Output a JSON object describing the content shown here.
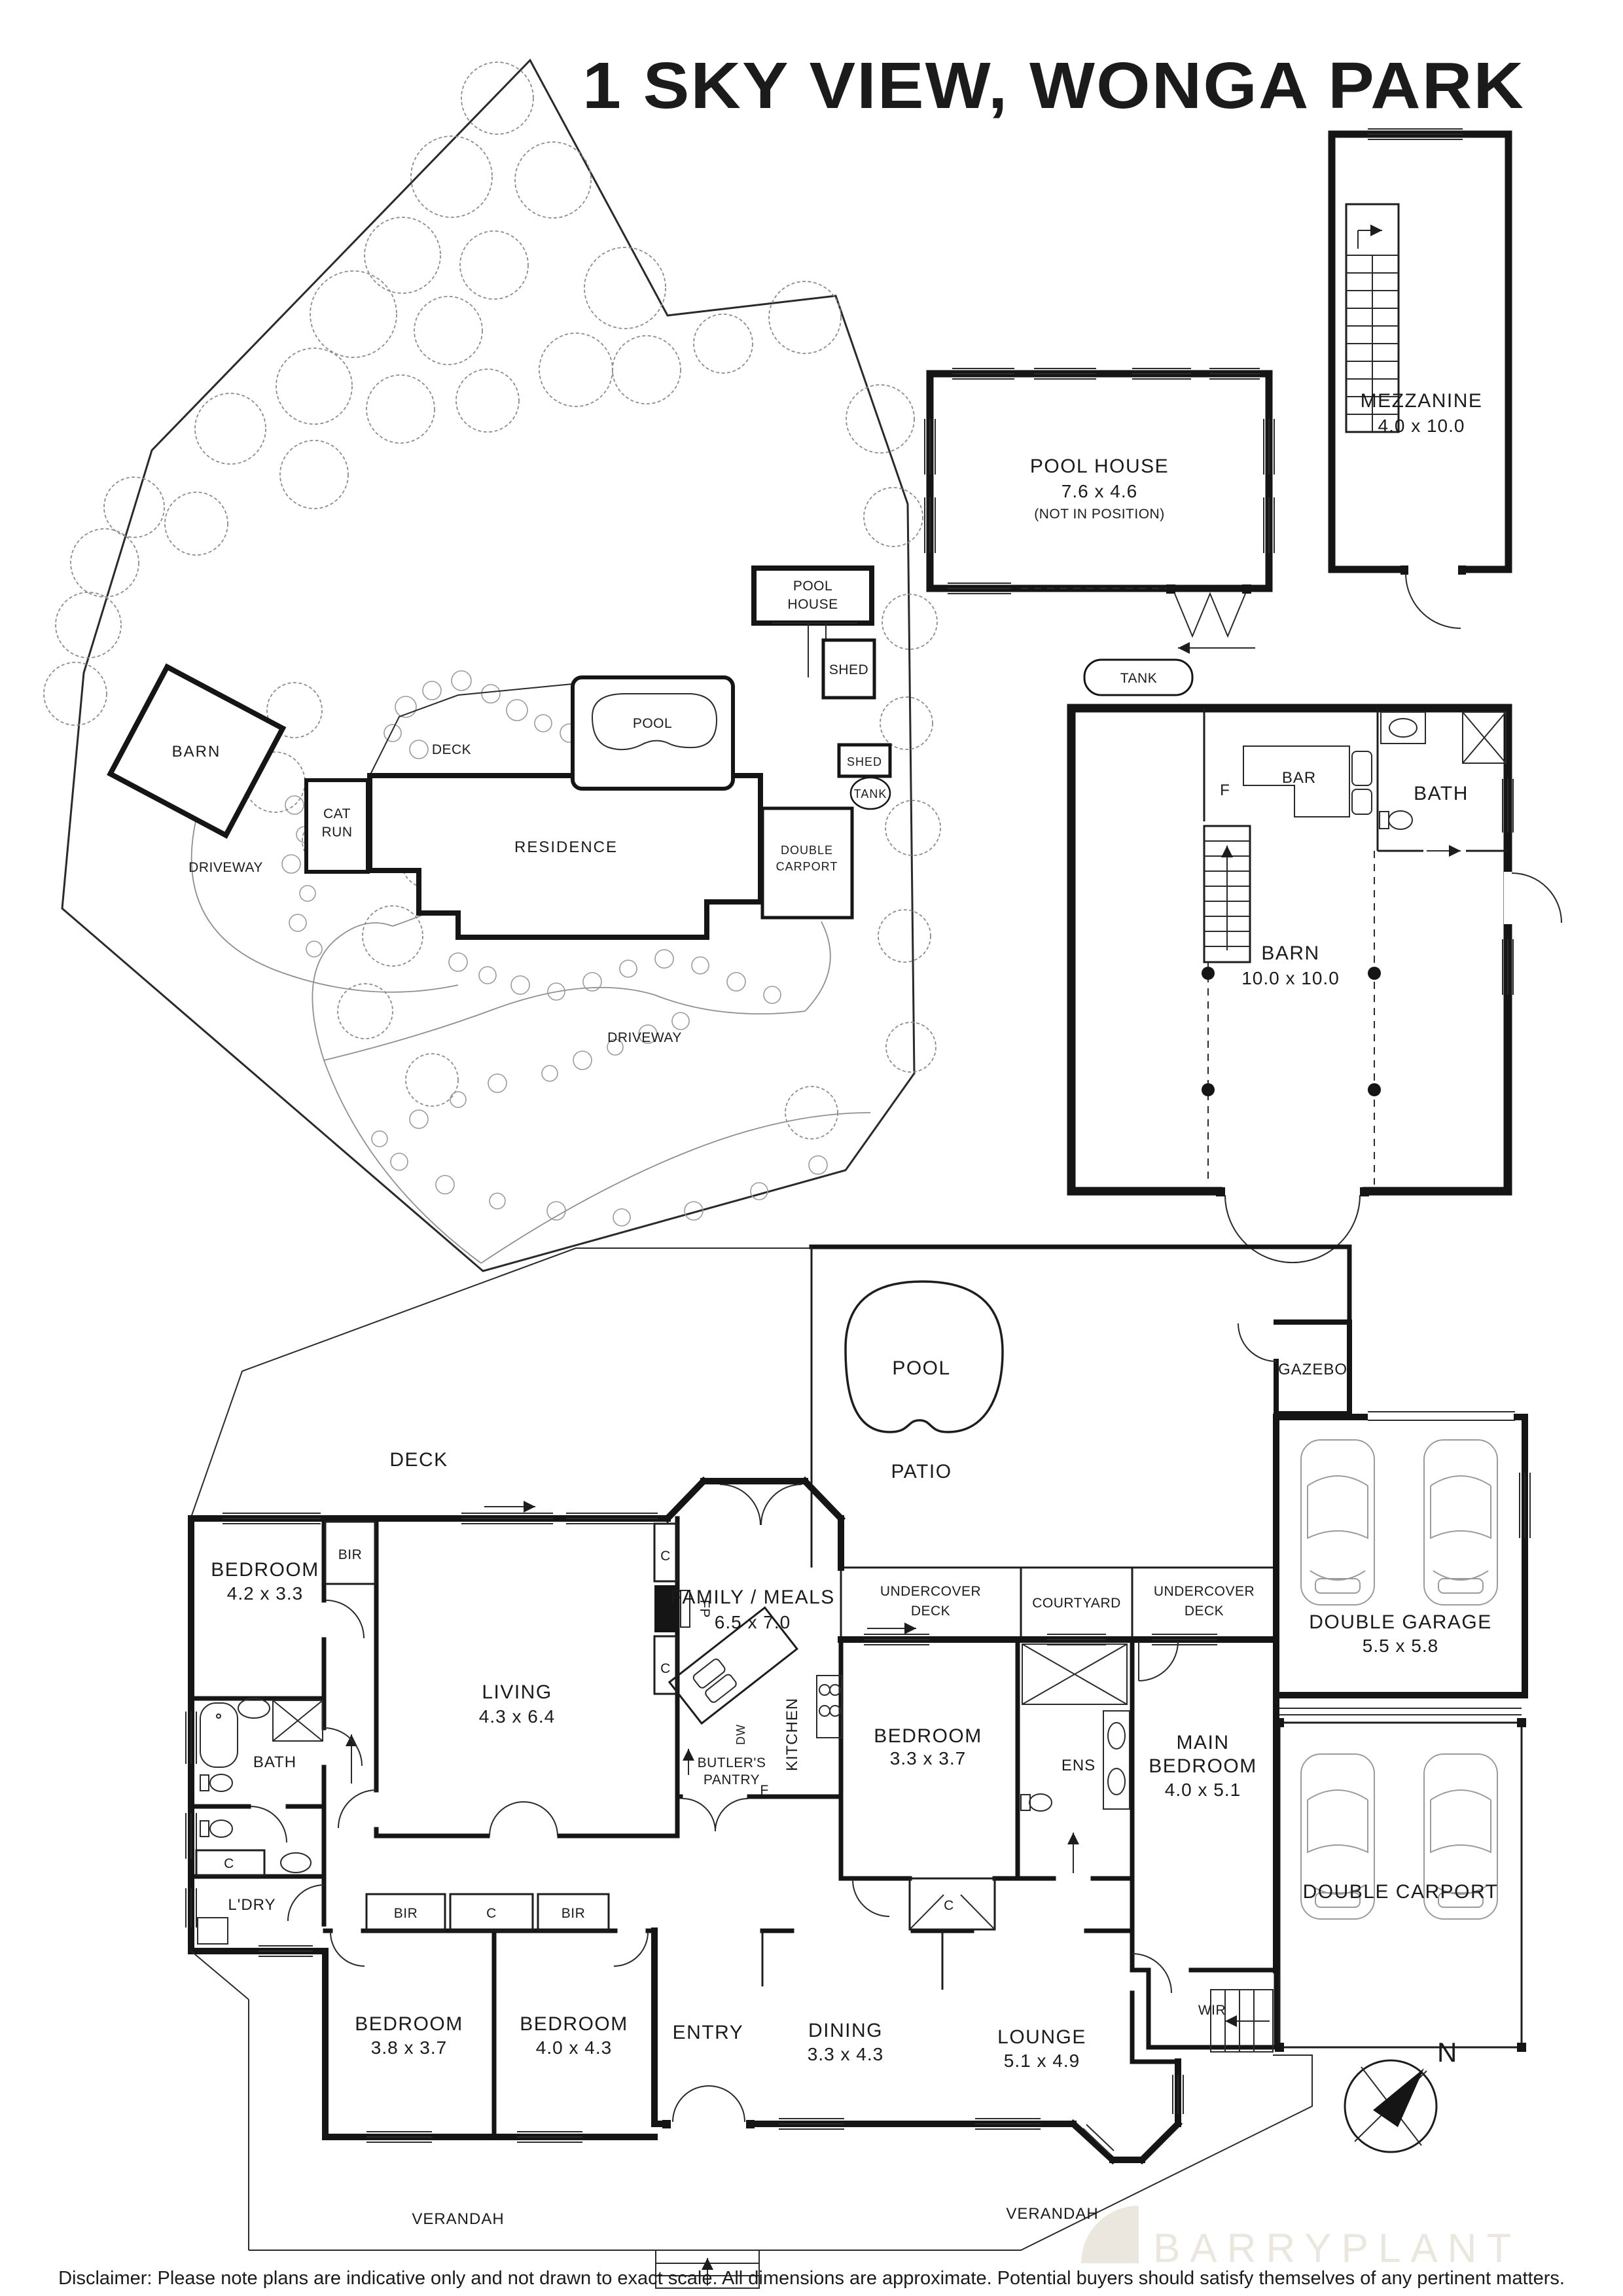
{
  "title": "1 SKY VIEW, WONGA PARK",
  "disclaimer": "Disclaimer: Please note plans are indicative only and not drawn to exact scale. All dimensions are approximate. Potential buyers should satisfy themselves of any pertinent matters.",
  "watermark": {
    "brand": "BARRYPLANT"
  },
  "compass": {
    "north": "N"
  },
  "site_plan": {
    "barn": "BARN",
    "driveway1": "DRIVEWAY",
    "driveway2": "DRIVEWAY",
    "cat_run_l1": "CAT",
    "cat_run_l2": "RUN",
    "deck": "DECK",
    "residence": "RESIDENCE",
    "pool": "POOL",
    "pool_house_l1": "POOL",
    "pool_house_l2": "HOUSE",
    "shed1": "SHED",
    "shed2": "SHED",
    "tank": "TANK",
    "carport_l1": "DOUBLE",
    "carport_l2": "CARPORT"
  },
  "pool_house_plan": {
    "name": "POOL HOUSE",
    "dims": "7.6 x 4.6",
    "note": "(NOT IN POSITION)"
  },
  "mezzanine_plan": {
    "name": "MEZZANINE",
    "dims": "4.0 x 10.0"
  },
  "barn_plan": {
    "tank": "TANK",
    "fridge": "F",
    "bar": "BAR",
    "bath": "BATH",
    "name": "BARN",
    "dims": "10.0 x 10.0"
  },
  "floor_plan": {
    "deck": "DECK",
    "pool": "POOL",
    "patio": "PATIO",
    "gazebo": "GAZEBO",
    "garage_name": "DOUBLE GARAGE",
    "garage_dims": "5.5 x 5.8",
    "carport": "DOUBLE CARPORT",
    "ud1_l1": "UNDERCOVER",
    "ud1_l2": "DECK",
    "courtyard": "COURTYARD",
    "ud2_l1": "UNDERCOVER",
    "ud2_l2": "DECK",
    "family_name": "FAMILY / MEALS",
    "family_dims": "6.5 x 7.0",
    "kitchen": "KITCHEN",
    "dw": "DW",
    "fridge": "F",
    "fp": "FP",
    "butlers_l1": "BUTLER'S",
    "butlers_l2": "PANTRY",
    "living_name": "LIVING",
    "living_dims": "4.3 x 6.4",
    "bedroom1_name": "BEDROOM",
    "bedroom1_dims": "4.2 x 3.3",
    "bir1": "BIR",
    "c_top": "C",
    "c_mid": "C",
    "c_hall": "C",
    "bath": "BATH",
    "ldry": "L'DRY",
    "bedroom3_name": "BEDROOM",
    "bedroom3_dims": "3.3 x 3.7",
    "ens": "ENS",
    "c_bed3": "C",
    "main_bed_l1": "MAIN",
    "main_bed_l2": "BEDROOM",
    "main_bed_l3": "4.0 x 5.1",
    "wir": "WIR",
    "bir2": "BIR",
    "c_band": "C",
    "bir3": "BIR",
    "bedroom4_name": "BEDROOM",
    "bedroom4_dims": "3.8 x 3.7",
    "bedroom5_name": "BEDROOM",
    "bedroom5_dims": "4.0 x 4.3",
    "entry": "ENTRY",
    "dining_name": "DINING",
    "dining_dims": "3.3 x 4.3",
    "lounge_name": "LOUNGE",
    "lounge_dims": "5.1 x 4.9",
    "verandah_left": "VERANDAH",
    "verandah_right": "VERANDAH"
  }
}
